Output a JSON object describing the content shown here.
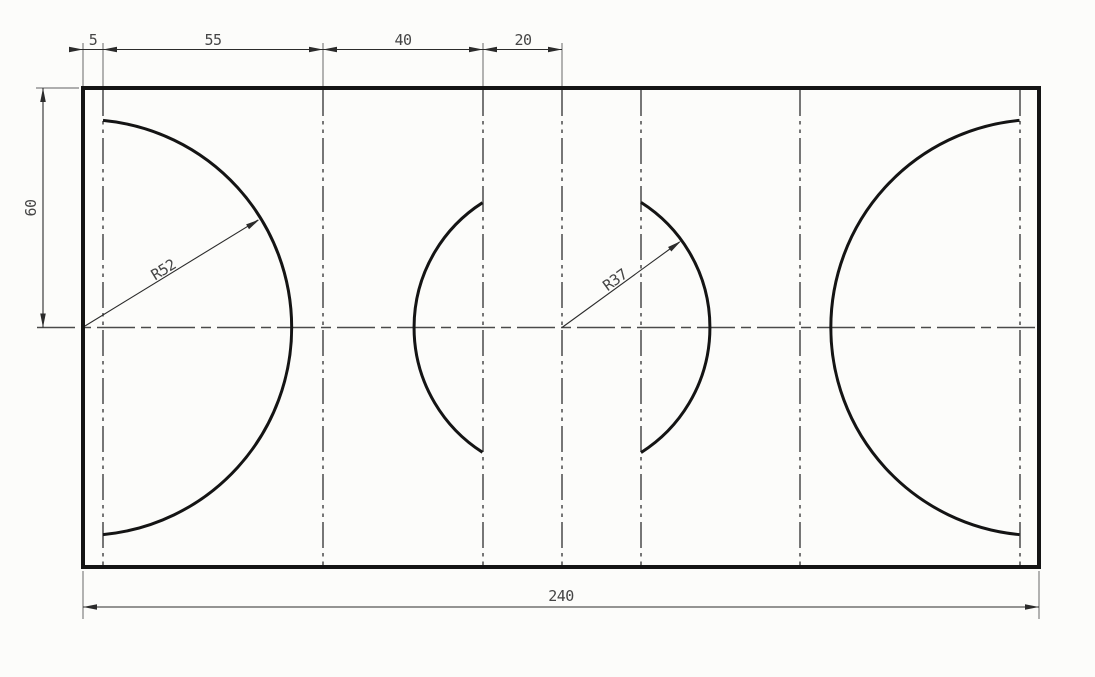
{
  "drawing": {
    "kind": "engineering-part-drawing",
    "description": "Rectangular plate, front view, with two large side arcs and two central arcs, dimensioned",
    "scale_px_per_unit": 4
  },
  "dimensions": {
    "top": [
      {
        "label": "5",
        "value": 5
      },
      {
        "label": "55",
        "value": 55
      },
      {
        "label": "40",
        "value": 40
      },
      {
        "label": "20",
        "value": 20
      }
    ],
    "left": {
      "label": "60",
      "value": 60
    },
    "bottom": {
      "label": "240",
      "value": 240
    },
    "radial": [
      {
        "label": "R52",
        "value": 52
      },
      {
        "label": "R37",
        "value": 37
      }
    ]
  },
  "colors": {
    "background": "#fcfcfa",
    "outline": "#141414",
    "centerline": "#4a4a4a",
    "extension": "#808080",
    "dimension": "#2b2b2b",
    "text": "#454545"
  }
}
